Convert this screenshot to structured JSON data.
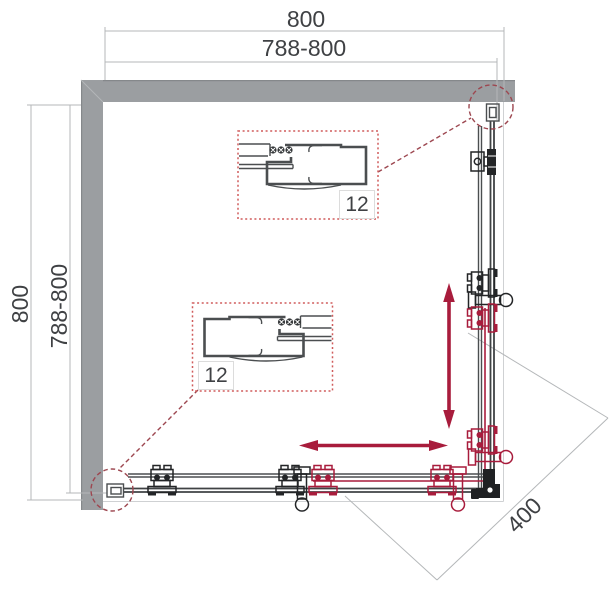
{
  "drawing_type": "shower-enclosure-square-corner-plan",
  "dimensions": {
    "width_top": {
      "overall": "800",
      "adjustable": "788-800"
    },
    "height_left": {
      "overall": "800",
      "adjustable": "788-800"
    },
    "corner_entry": "400"
  },
  "detail_callouts": [
    {
      "label": "12"
    },
    {
      "label": "12"
    }
  ],
  "colors": {
    "wall": "#9b9ea1",
    "wall-edge": "#85888b",
    "profile": "#4b4e50",
    "hardware-black": "#232527",
    "accent-red": "#a81c3c",
    "callout-red": "#d05c5c",
    "detail-red": "#9d4750",
    "dim-line": "#b4b7b9",
    "dim-text": "#3f4144"
  }
}
